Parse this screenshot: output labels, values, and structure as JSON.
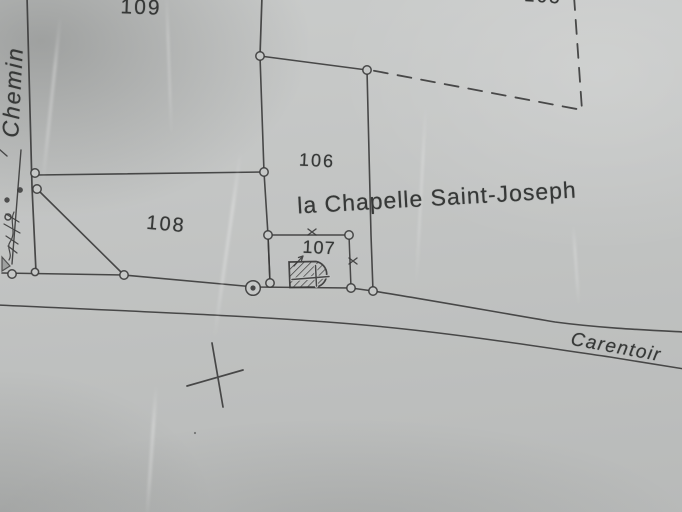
{
  "map": {
    "labels": {
      "road_left": "Chemin",
      "road_bottom": "Carentoir",
      "place": "la Chapelle Saint-Joseph"
    },
    "parcels": {
      "p105": "105",
      "p106": "106",
      "p107": "107",
      "p108": "108",
      "p109": "109"
    },
    "symbols": {
      "survey_cross": "tilted-plus-cross-mark",
      "monument": "double-circle-marker",
      "boundary_point": "small-circle-marker",
      "building": "hatched-chapel-footprint-with-cross",
      "limit_style": "dashed-parcel-limit"
    },
    "colors": {
      "paper": "#c6c8c7",
      "ink": "#3a3a3a"
    }
  }
}
